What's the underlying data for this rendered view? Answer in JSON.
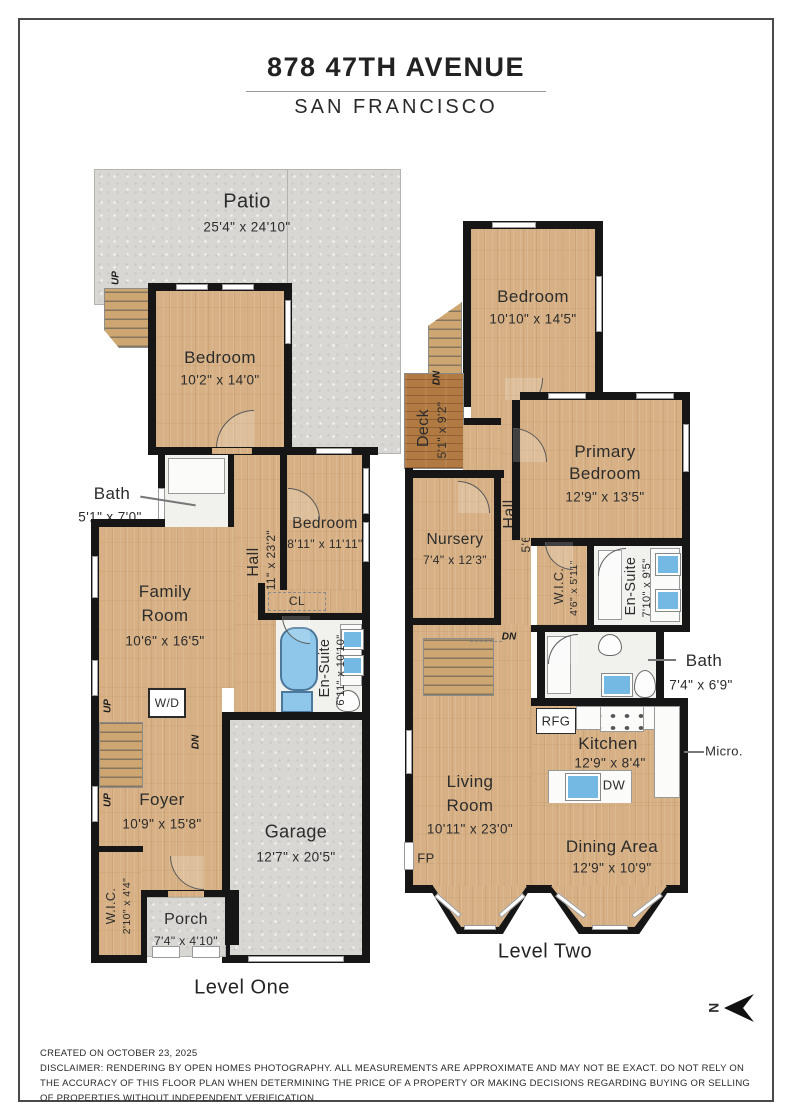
{
  "header": {
    "title": "878 47TH AVENUE",
    "subtitle": "SAN FRANCISCO"
  },
  "labels": {
    "up": "UP",
    "dn": "DN"
  },
  "compass": {
    "north": "N"
  },
  "level_one": {
    "caption": "Level One",
    "patio": {
      "name": "Patio",
      "dims": "25'4\" x 24'10\""
    },
    "bedroom_upper": {
      "name": "Bedroom",
      "dims": "10'2\" x 14'0\""
    },
    "bath": {
      "name": "Bath",
      "dims": "5'1\" x 7'0\""
    },
    "hall": {
      "name": "Hall",
      "dims": "4'11\" x 23'2\""
    },
    "bedroom_mid": {
      "name": "Bedroom",
      "dims": "8'11\" x 11'11\""
    },
    "closet": {
      "name": "CL"
    },
    "ensuite": {
      "name": "En-Suite",
      "dims": "6'11\" x 10'10\""
    },
    "family_room": {
      "line1": "Family",
      "line2": "Room",
      "dims": "10'6\" x 16'5\""
    },
    "washer_dryer": {
      "name": "W/D"
    },
    "foyer": {
      "name": "Foyer",
      "dims": "10'9\" x 15'8\""
    },
    "mech": {
      "name": "Mech."
    },
    "garage": {
      "name": "Garage",
      "dims": "12'7\" x 20'5\""
    },
    "wic": {
      "name": "W.I.C.",
      "dims": "2'10\" x 4'4\""
    },
    "porch": {
      "name": "Porch",
      "dims": "7'4\" x 4'10\""
    }
  },
  "level_two": {
    "caption": "Level Two",
    "bedroom": {
      "name": "Bedroom",
      "dims": "10'10\" x 14'5\""
    },
    "deck": {
      "name": "Deck",
      "dims": "5'1\" x 9'2\""
    },
    "primary_bedroom": {
      "line1": "Primary",
      "line2": "Bedroom",
      "dims": "12'9\" x 13'5\""
    },
    "nursery": {
      "name": "Nursery",
      "dims": "7'4\" x 12'3\""
    },
    "hall": {
      "name": "Hall",
      "dims": "5'6\" x 20'10\""
    },
    "wic": {
      "name": "W.I.C.",
      "dims": "4'6\" x 5'11\""
    },
    "ensuite": {
      "name": "En-Suite",
      "dims": "7'10\" x 9'5\""
    },
    "bath": {
      "name": "Bath",
      "dims": "7'4\" x 6'9\""
    },
    "kitchen": {
      "name": "Kitchen",
      "dims": "12'9\" x 8'4\""
    },
    "rfg": {
      "name": "RFG"
    },
    "dw": {
      "name": "DW"
    },
    "kitchen_bar": {
      "name": "Kitchen Bar"
    },
    "micro": {
      "name": "Micro."
    },
    "living_room": {
      "line1": "Living",
      "line2": "Room",
      "dims": "10'11\" x 23'0\""
    },
    "dining_area": {
      "name": "Dining Area",
      "dims": "12'9\" x 10'9\""
    },
    "fp": {
      "name": "FP"
    }
  },
  "footer": {
    "created": "CREATED ON OCTOBER 23, 2025",
    "disclaimer": "DISCLAIMER: RENDERING BY OPEN HOMES PHOTOGRAPHY. ALL MEASUREMENTS ARE APPROXIMATE AND MAY NOT BE EXACT. DO NOT RELY ON THE ACCURACY OF THIS FLOOR PLAN WHEN DETERMINING THE PRICE OF A PROPERTY OR MAKING DECISIONS REGARDING BUYING OR SELLING OF PROPERTIES WITHOUT INDEPENDENT VERIFICATION."
  }
}
